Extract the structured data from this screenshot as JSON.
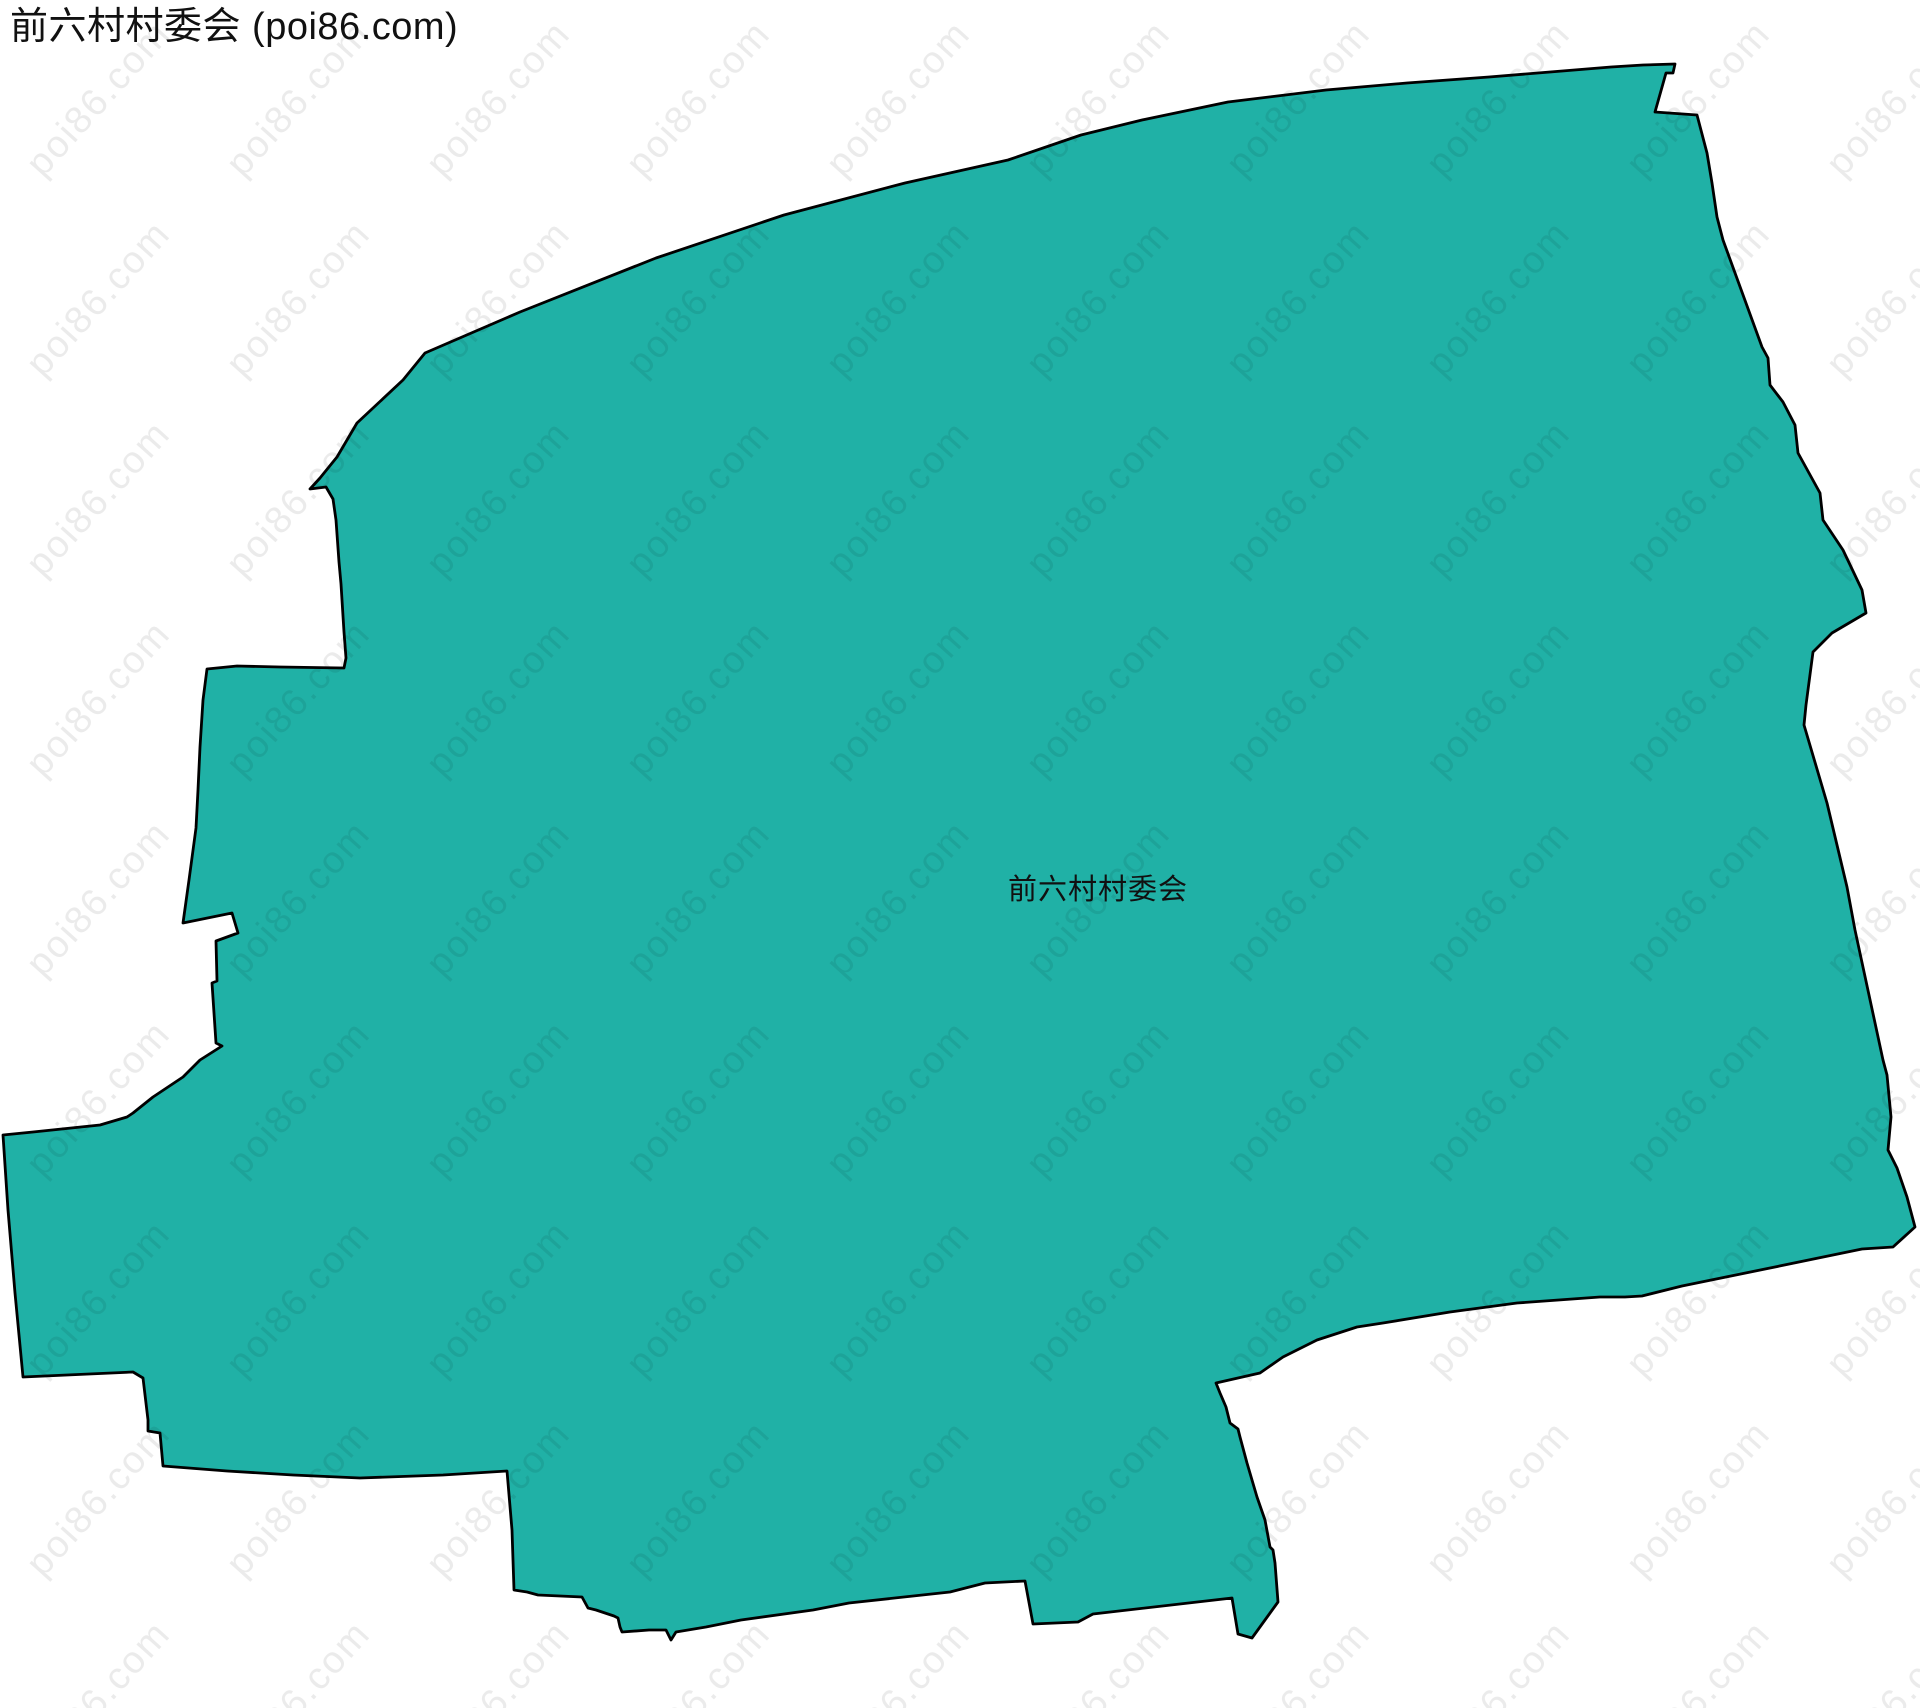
{
  "page": {
    "title": "前六村村委会 (poi86.com)",
    "region_label": "前六村村委会",
    "watermark_text": "poi86.com"
  },
  "colors": {
    "background": "#ffffff",
    "region_fill": "#20b1a6",
    "region_stroke": "#000000",
    "title_color": "#111111",
    "label_color": "#111111",
    "watermark_color": "#000000",
    "watermark_opacity": "0.08"
  },
  "map": {
    "region_name": "前六村村委会",
    "polygon_points": "425,353 403,380 357,423 337,457 320,478 310,489 326,487 333,499 336,520 339,562 341,584 344,632 346,658 344,668 280,667 237,666 207,669 203,700 200,747 198,790 196,828 189,880 183,923 232,913 238,933 216,941 217,981 212,983 216,1043 222,1046 200,1060 183,1077 153,1097 133,1113 127,1117 100,1125 33,1132 3,1135 8,1210 15,1293 23,1377 67,1375 133,1372 143,1378 148,1420 148,1431 160,1433 163,1466 227,1471 293,1475 360,1478 443,1475 507,1471 512,1530 514,1590 527,1592 538,1595 582,1597 588,1608 596,1610 614,1616 618,1618 620,1627 622,1632 649,1630 666,1630 671,1640 676,1632 706,1627 741,1620 813,1610 849,1603 950,1592 985,1583 1025,1581 1033,1624 1078,1622 1093,1614 1232,1598 1238,1634 1252,1638 1278,1602 1275,1563 1273,1550 1270,1547 1265,1520 1257,1497 1247,1463 1240,1437 1238,1429 1230,1423 1226,1407 1220,1393 1216,1383 1260,1373 1283,1357 1317,1340 1357,1327 1383,1323 1450,1312 1517,1303 1600,1297 1625,1297 1642,1296 1682,1286 1770,1268 1862,1249 1893,1247 1915,1227 1907,1197 1897,1168 1888,1150 1891,1117 1887,1075 1883,1060 1855,930 1847,887 1827,803 1804,725 1806,705 1813,652 1832,633 1866,613 1862,590 1843,550 1823,520 1820,493 1798,453 1795,425 1783,402 1770,385 1768,358 1762,347 1723,240 1717,217 1712,183 1707,153 1697,115 1655,112 1666,73 1673,73 1675,64 1643,65 1611,67 1550,72 1489,77 1407,83 1326,90 1228,102 1142,120 1081,135 1008,160 905,183 784,215 656,258 520,312",
    "watermark_tile_size": "200",
    "watermark_font_size": "38",
    "watermark_rotation": "-48"
  }
}
